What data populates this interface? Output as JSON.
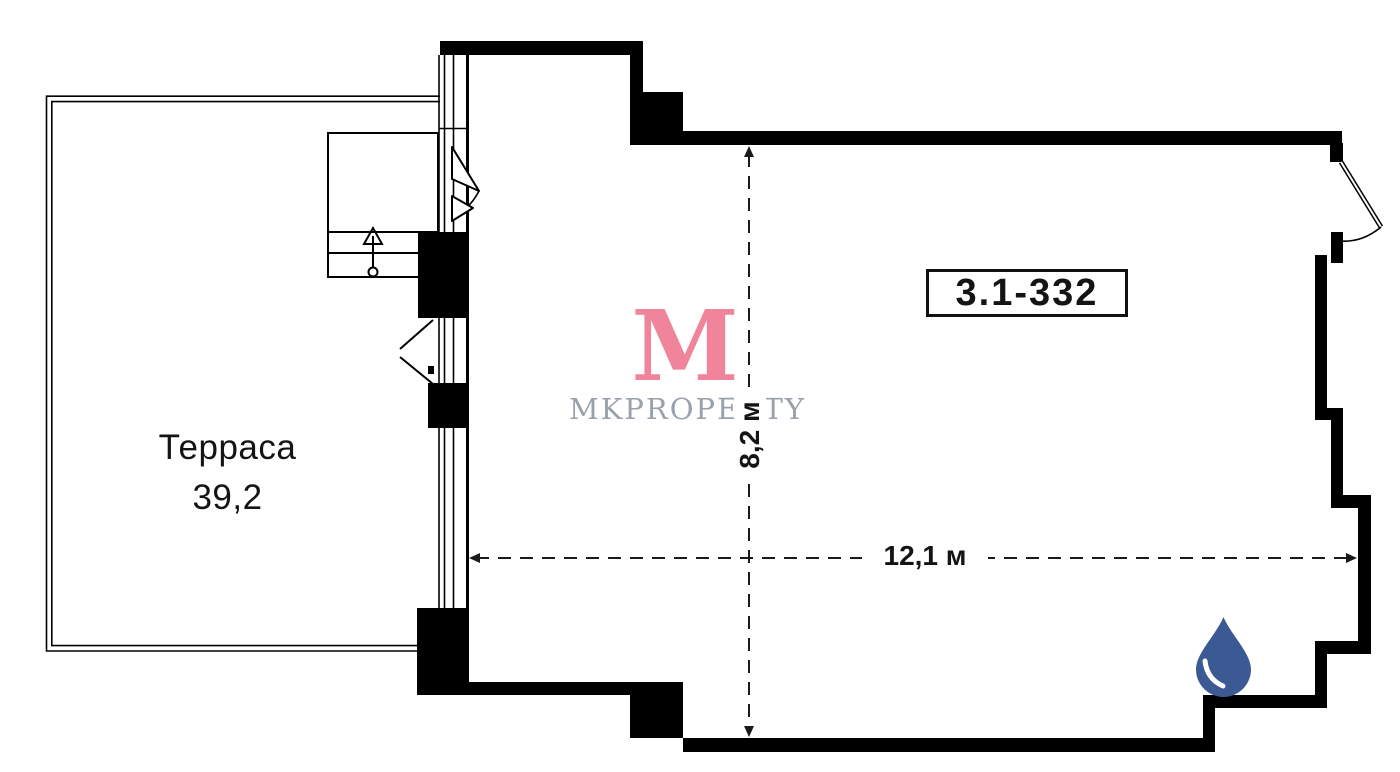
{
  "plan": {
    "terrace": {
      "name": "Терраса",
      "area": "39,2"
    },
    "room": {
      "number": "3.1-332"
    },
    "dimensions": {
      "width": "12,1 м",
      "height": "8,2 м"
    }
  },
  "watermark": {
    "logo_letter": "M",
    "brand": "MKPROPERTY"
  },
  "icons": {
    "water_drop": "water-drop-icon"
  },
  "colors": {
    "wall": "#000000",
    "watermark_pink": "#F0849B",
    "watermark_gray": "#99A1AB",
    "drop_blue": "#3B5A94",
    "dimension_line": "#1A1A1A"
  }
}
